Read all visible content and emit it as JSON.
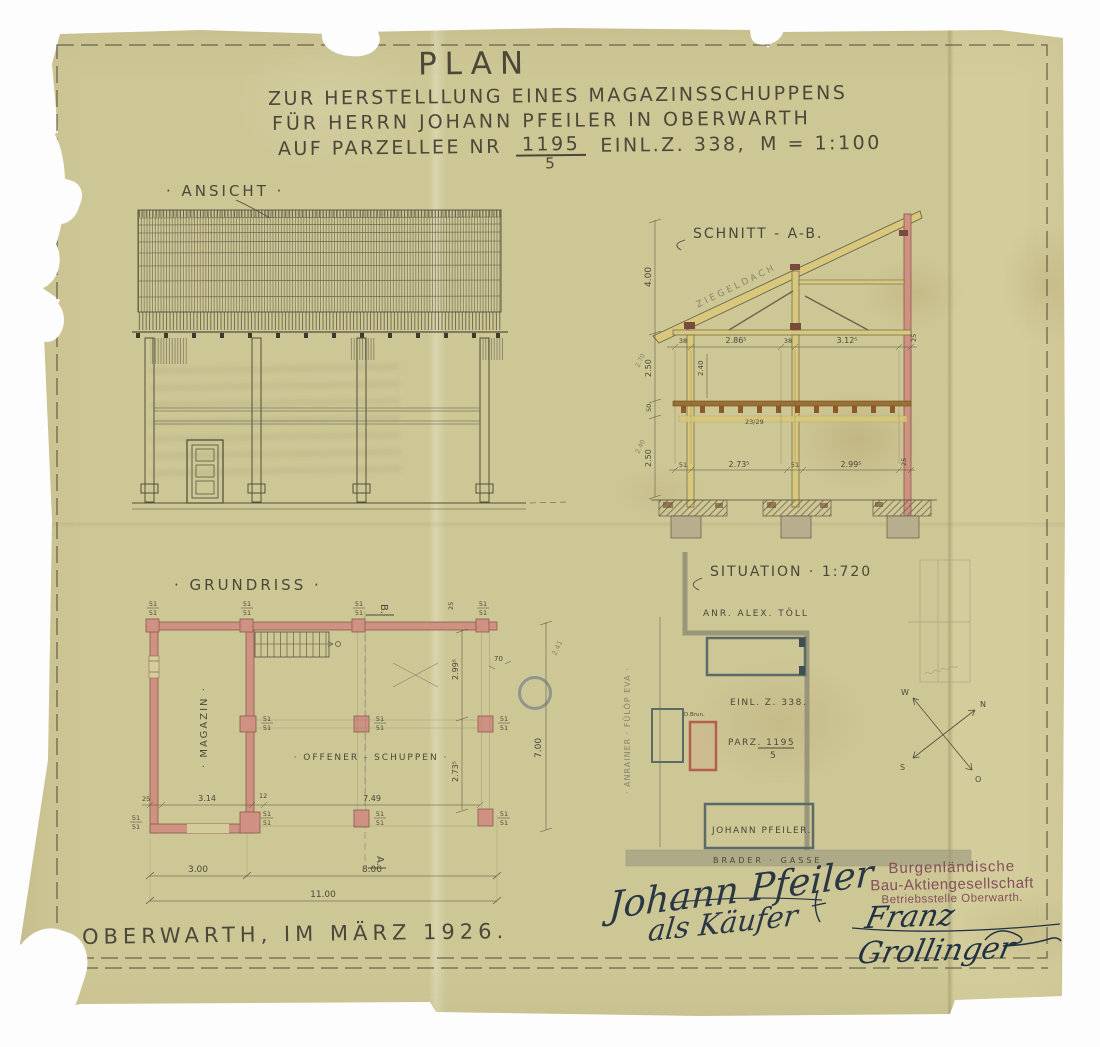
{
  "colors": {
    "paper": "#cdc695",
    "ink": "#4c4839",
    "pencil": "#8b8571",
    "wall_pink": "#cf9182",
    "wood_yellow": "#d8c87c",
    "beam_brown": "#9c7034",
    "site_grey": "#8f8d76",
    "building_grey": "#5c6a68",
    "red_outline": "#b55f4f",
    "stamp_purple": "#7d4254",
    "signature_ink": "#2a3845"
  },
  "title": {
    "plan": "PLAN",
    "line2": "ZUR HERSTELLLUNG EINES MAGAZINSSCHUPPENS",
    "line3": "FÜR HERRN JOHANN PFEILER IN OBERWARTH",
    "line4a": "AUF PARZELLEE NR",
    "parcel_num": "1195",
    "parcel_den": "5",
    "line4b": "EINL.Z. 338,",
    "scale": "M = 1:100"
  },
  "ansicht": {
    "label": "· ANSICHT ·"
  },
  "schnitt": {
    "label": "SCHNITT - A-B.",
    "roof_text": "ZIEGELDACH",
    "joist_text": "23/29",
    "dims_top": [
      "38",
      "2.86⁵",
      "38",
      "3.12⁵",
      "25"
    ],
    "dims_bottom": [
      "51",
      "2.73⁵",
      "51",
      "2.99⁵",
      "25"
    ],
    "dims_left": [
      "4.00",
      "2.50",
      "50",
      "2.50"
    ],
    "dim_inner": "2.40",
    "pencil_notes": [
      "2.70",
      "2.40"
    ]
  },
  "grundriss": {
    "label": "· GRUNDRISS ·",
    "section_top": "B.",
    "section_bottom": "A.",
    "room_left": "· MAGAZIN ·",
    "room_right": "· OFFENER - SCHUPPEN ·",
    "post_size": "51",
    "dim_25": "25",
    "dim_314": "3.14",
    "dim_12": "12",
    "dim_749": "7.49",
    "dim_300": "3.00",
    "dim_800": "8.00",
    "dim_1100": "11.00",
    "dim_2995": "2.99⁵",
    "dim_70": "70",
    "dim_241": "2.41",
    "dim_700": "7.00",
    "dim_2735": "2.73⁵"
  },
  "situation": {
    "label": "SITUATION · 1:720",
    "neighbor_top": "ANR. ALEX. TÖLL",
    "neighbor_left": "· ANRAINER · FÜLÖP EVA ·",
    "einlage": "EINL. Z. 338.",
    "parcel": "PARZ. 1195",
    "parcel_den": "5",
    "well": "D.Brun.",
    "owner": "JOHANN PFEILER.",
    "street": "BRADER · GASSE",
    "compass_n": "N",
    "compass_o": "O",
    "compass_s": "S",
    "compass_w": "W"
  },
  "footer": {
    "place_date": "OBERWARTH, IM MÄRZ 1926.",
    "signature_name": "Johann Pfeiler",
    "signature_role": "als Käufer",
    "stamp_line1": "Burgenländische",
    "stamp_line2": "Bau-Aktiengesellschaft",
    "stamp_line3": "Betriebsstelle Oberwarth.",
    "stamp_signature": "Franz Grollinger"
  }
}
